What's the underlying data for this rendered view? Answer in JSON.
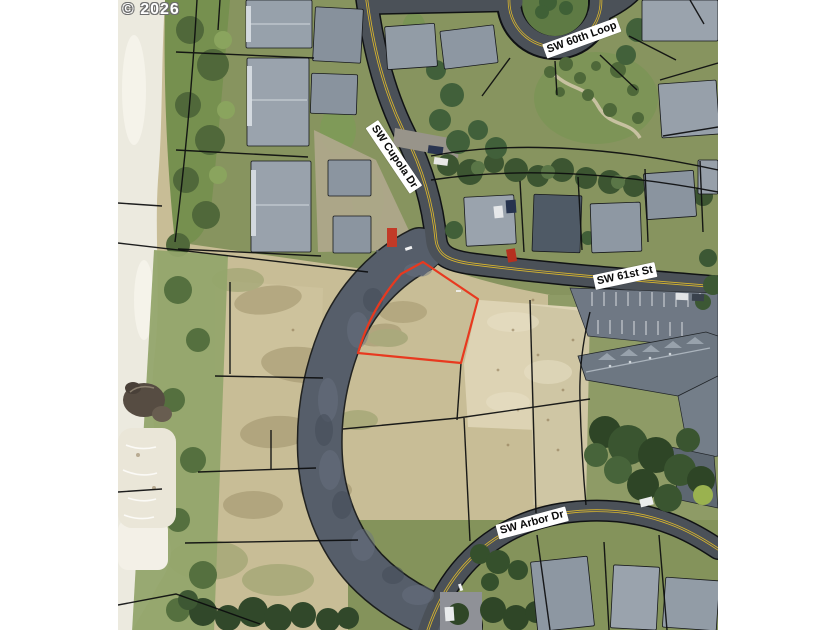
{
  "watermark": {
    "text": "© 2026"
  },
  "map": {
    "street_labels": [
      {
        "id": "sw-60th-loop",
        "text": "SW 60th Loop"
      },
      {
        "id": "sw-cupola-dr",
        "text": "SW Cupola Dr"
      },
      {
        "id": "sw-61st-st",
        "text": "SW 61st St"
      },
      {
        "id": "sw-arbor-dr",
        "text": "SW Arbor Dr"
      }
    ],
    "highlighted_parcel_color": "#e8391f",
    "colors": {
      "road_centerline_yellow": "#d9b62e",
      "parcel_line": "#0c0d0e",
      "label_background": "#ffffff",
      "label_text": "#0a0a0a",
      "page_background": "#ffffff"
    }
  }
}
